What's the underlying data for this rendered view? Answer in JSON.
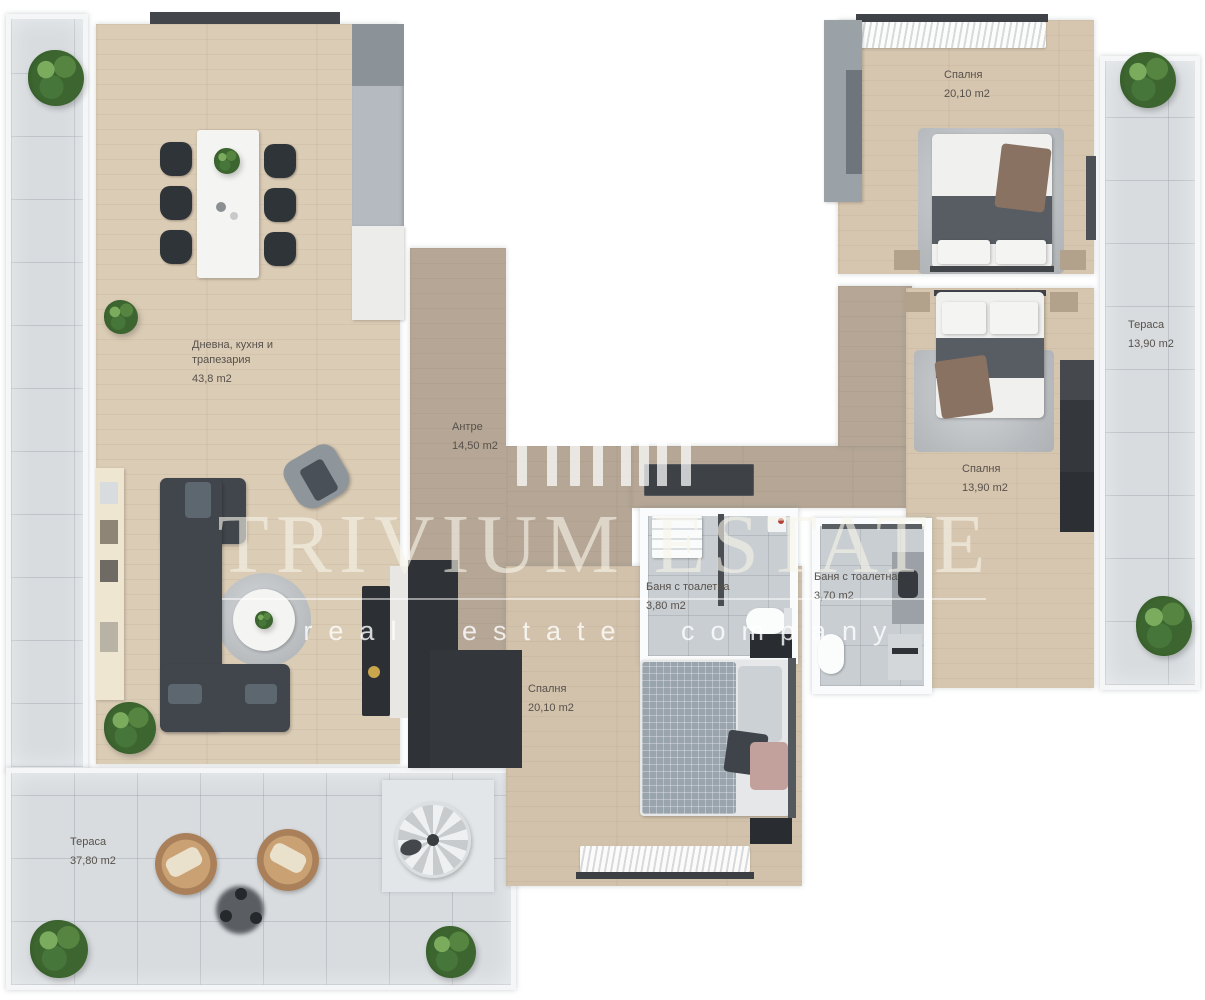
{
  "watermark": {
    "title": "TRIVIUM ESTATE",
    "subtitle": "real estate company",
    "logo": "trivium-building-skyline"
  },
  "rooms": {
    "living": {
      "name": "Дневна, кухня и трапезария",
      "area": "43,8 m2"
    },
    "antre": {
      "name": "Антре",
      "area": "14,50 m2"
    },
    "bedroom_top": {
      "name": "Спалня",
      "area": "20,10 m2"
    },
    "bedroom_mid": {
      "name": "Спалня",
      "area": "13,90 m2"
    },
    "bedroom_bottom": {
      "name": "Спалня",
      "area": "20,10 m2"
    },
    "bath_left": {
      "name": "Баня с тоалетна",
      "area": "3,80 m2"
    },
    "bath_right": {
      "name": "Баня с тоалетна",
      "area": "3,70 m2"
    },
    "terrace_right": {
      "name": "Тераса",
      "area": "13,90 m2"
    },
    "terrace_bottom": {
      "name": "Тераса",
      "area": "37,80 m2"
    }
  },
  "palette": {
    "wood_floor": "#dbccb5",
    "hall_floor": "#b5a695",
    "bedroom_floor": "#d6c6af",
    "terrace_tile": "#d8dcdf",
    "bath_tile": "#c9ced2",
    "wall": "#ffffff",
    "dark_furniture": "#34383d",
    "plant_green": "#3c652f",
    "label_text": "#57514b",
    "watermark_text": "#f6f2e8"
  }
}
